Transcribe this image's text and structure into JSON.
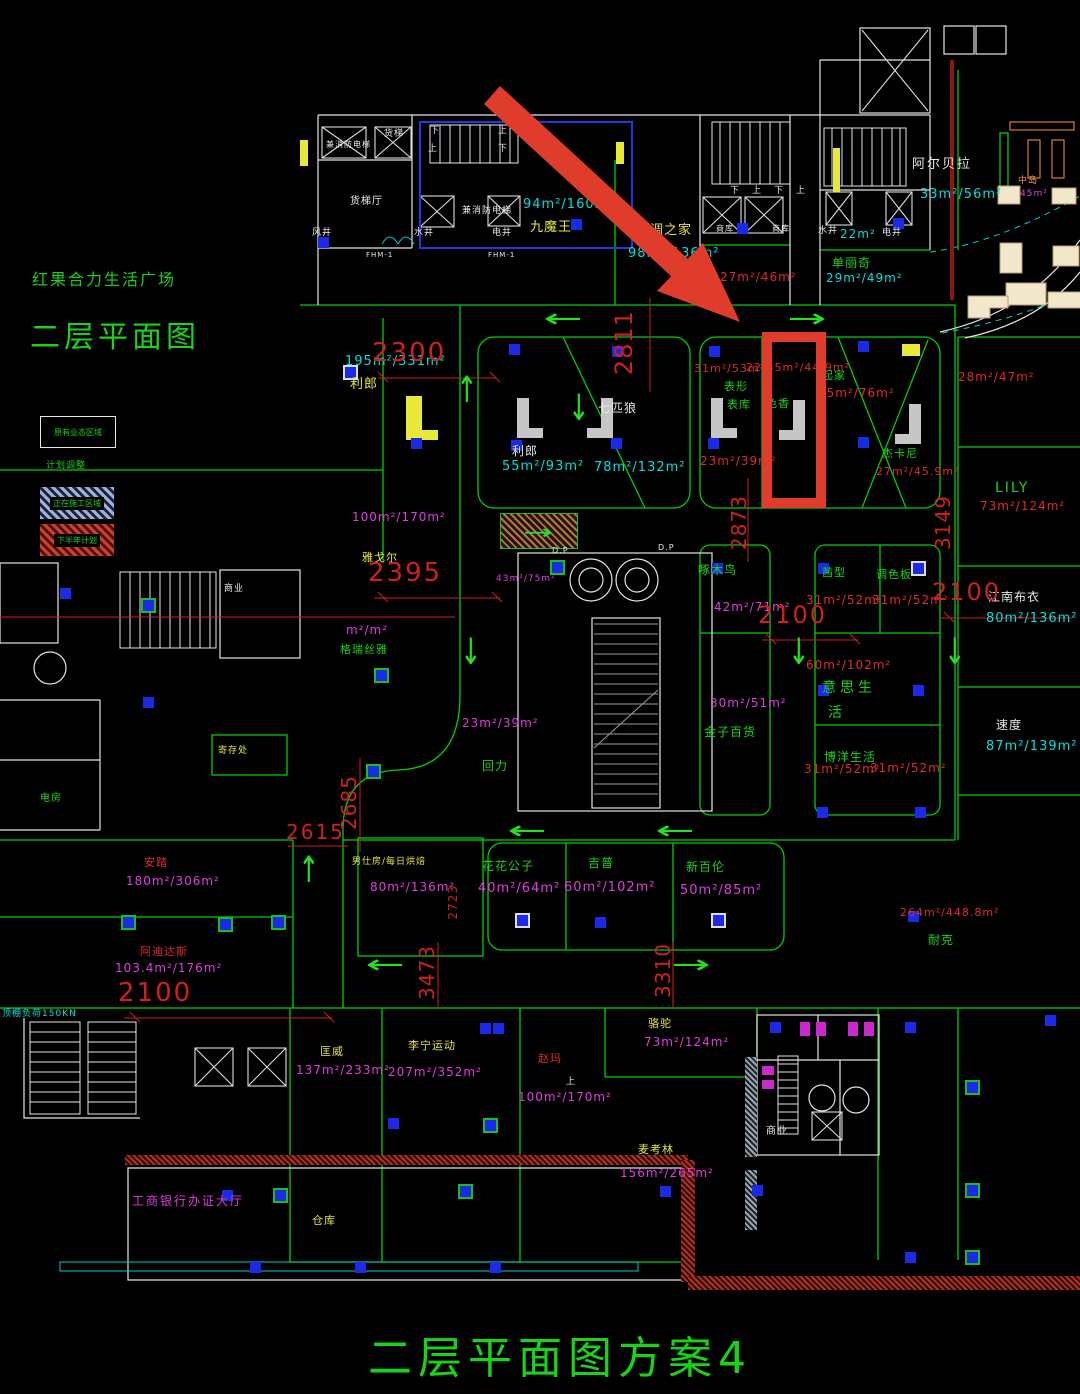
{
  "titles": {
    "project": "红果合力生活广场",
    "drawing": "二层平面图",
    "footer": "二层平面图方案4"
  },
  "legend": {
    "existing": "原有业态区域",
    "plan": "计划调整",
    "construction": "正在施工区域",
    "next_half": "下半年计划"
  },
  "shops": {
    "jmw": {
      "name": "九魔王",
      "area": "94m²/160m²"
    },
    "ktzj": {
      "name": "空调之家",
      "area": "98m²/136m²"
    },
    "dlq": {
      "name": "单丽奇",
      "area": "29m²/49m²"
    },
    "aebl": {
      "name": "阿尔贝拉",
      "area": "33m²/56m²"
    },
    "lilang1": {
      "name": "利郎",
      "area": "195m²/331m²"
    },
    "lilang2": {
      "name": "利郎",
      "area": "55m²/93m²"
    },
    "qpl": {
      "name": "七匹狼",
      "area": "78m²/132m²"
    },
    "biaoxing": {
      "name": "表形",
      "name2": "表库",
      "area": "31m²/53m²",
      "area2": "23m²/39m²"
    },
    "sexiang": {
      "name": "色香",
      "area": "22.35m²/44.9m²"
    },
    "qijia": {
      "name": "起家",
      "area": "45m²/76m²"
    },
    "jkn": {
      "name": "杰卡尼",
      "area": "27m²/45.9m²"
    },
    "lily": {
      "name": "LILY",
      "area": "73m²/124m²"
    },
    "jnby": {
      "name": "江南布衣",
      "area": "80m²/136m²"
    },
    "sudu": {
      "name": "速度",
      "area": "87m²/139m²"
    },
    "zmn": {
      "name": "啄木鸟",
      "area": "42m²/71m²"
    },
    "jzbh": {
      "name": "金子百货",
      "area": "30m²/51m²"
    },
    "qianxing": {
      "name": "茜型",
      "area": "31m²/52m²"
    },
    "tsb": {
      "name": "调色板",
      "area": "31m²/52m²"
    },
    "yssh": {
      "name": "意思生",
      "name2": "活",
      "area": "60m²/102m²"
    },
    "bysh": {
      "name": "博洋生活",
      "area": "31m²/52m²",
      "area2": "31m²/52m²"
    },
    "huili": {
      "name": "回力",
      "area": "23m²/39m²"
    },
    "grsy": {
      "name": "格瑞丝雅",
      "area": "m²/m²"
    },
    "ygr": {
      "name": "雅戈尔",
      "area": "100m²/170m²"
    },
    "nsf": {
      "name": "男仕房/每日烘焙",
      "area": "80m²/136m²"
    },
    "hhgz": {
      "name": "花花公子",
      "area": "40m²/64m²"
    },
    "jipu": {
      "name": "吉普",
      "area": "60m²/102m²"
    },
    "xbl": {
      "name": "新百伦",
      "area": "50m²/85m²"
    },
    "nike": {
      "name": "耐克",
      "area": "264m²/448.8m²"
    },
    "anta": {
      "name": "安踏",
      "area": "180m²/306m²"
    },
    "adds": {
      "name": "阿迪达斯",
      "area": "103.4m²/176m²"
    },
    "kw": {
      "name": "匡威",
      "area": "137m²/233m²"
    },
    "lnyd": {
      "name": "李宁运动",
      "area": "207m²/352m²"
    },
    "zhaoma": {
      "name": "赵玛",
      "area": "100m²/170m²"
    },
    "luotuo": {
      "name": "骆驼",
      "area": "73m²/124m²"
    },
    "mkl": {
      "name": "麦考林",
      "area": "156m²/265m²"
    },
    "bank": {
      "name": "工商银行办证大厅"
    },
    "cangku": {
      "name": "仓库"
    },
    "zhongdao": {
      "name": "中岛",
      "area": "45m²"
    },
    "area_2847": "28m²/47m²",
    "area_2746": "27m²/46m²",
    "area_22": "22m²",
    "area_4375": "43m²/75m²"
  },
  "service": {
    "huotiting": "货梯厅",
    "huoti": "货梯",
    "huoti_fire": "兼消防电梯",
    "jianxiaofang": "兼消防电梯",
    "shuijing": "水井",
    "dianjing": "电井",
    "fengjing": "风井",
    "shangku": "商库",
    "dianfang": "电房",
    "jicunchu": "寄存处",
    "shangye": "商业",
    "dp": "D.P",
    "up": "上",
    "down": "下",
    "fhm": "FHM-1",
    "load": "顶棚负荷150KN"
  },
  "dims": {
    "d2300": "2300",
    "d2395": "2395",
    "d2811": "2811",
    "d2873": "2873",
    "d3149": "3149",
    "d2100": "2100",
    "d2685": "2685",
    "d2615": "2615",
    "d2723": "2723",
    "d3473": "3473",
    "d3310": "3310"
  },
  "annotation": {
    "highlight_color": "#e03c2c",
    "highlighted_shop": "色香"
  },
  "colors": {
    "wall_green": "#00cf00",
    "text_green": "#17d417",
    "cyan": "#00dede",
    "red": "#e02a2a",
    "magenta": "#e03ce0",
    "yellow": "#e8e838",
    "dim_red": "#cf2020",
    "column_blue": "#1b2ae6"
  }
}
